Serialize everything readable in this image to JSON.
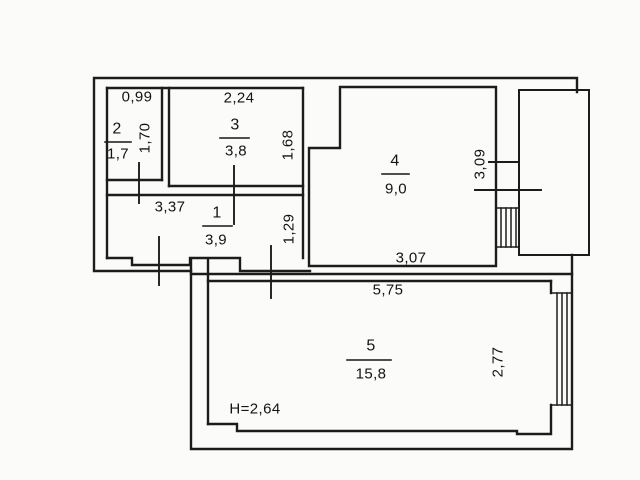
{
  "plan": {
    "title": "apartment-floor-plan",
    "rooms": [
      {
        "number": "1",
        "area": "3,9"
      },
      {
        "number": "2",
        "area": "1,7"
      },
      {
        "number": "3",
        "area": "3,8"
      },
      {
        "number": "4",
        "area": "9,0"
      },
      {
        "number": "5",
        "area": "15,8"
      }
    ],
    "dimensions": {
      "room2_width": "0,99",
      "room2_depth": "1,70",
      "room3_width": "2,24",
      "room3_depth": "1,68",
      "room1_width": "3,37",
      "room1_depth": "1,29",
      "room4_width": "3,07",
      "room4_depth": "3,09",
      "room5_width": "5,75",
      "room5_depth": "2,77",
      "ceiling_height": "H=2,64"
    },
    "colors": {
      "line": "#1c1c1c",
      "paper": "#fbfbf9",
      "text": "#141414"
    }
  }
}
